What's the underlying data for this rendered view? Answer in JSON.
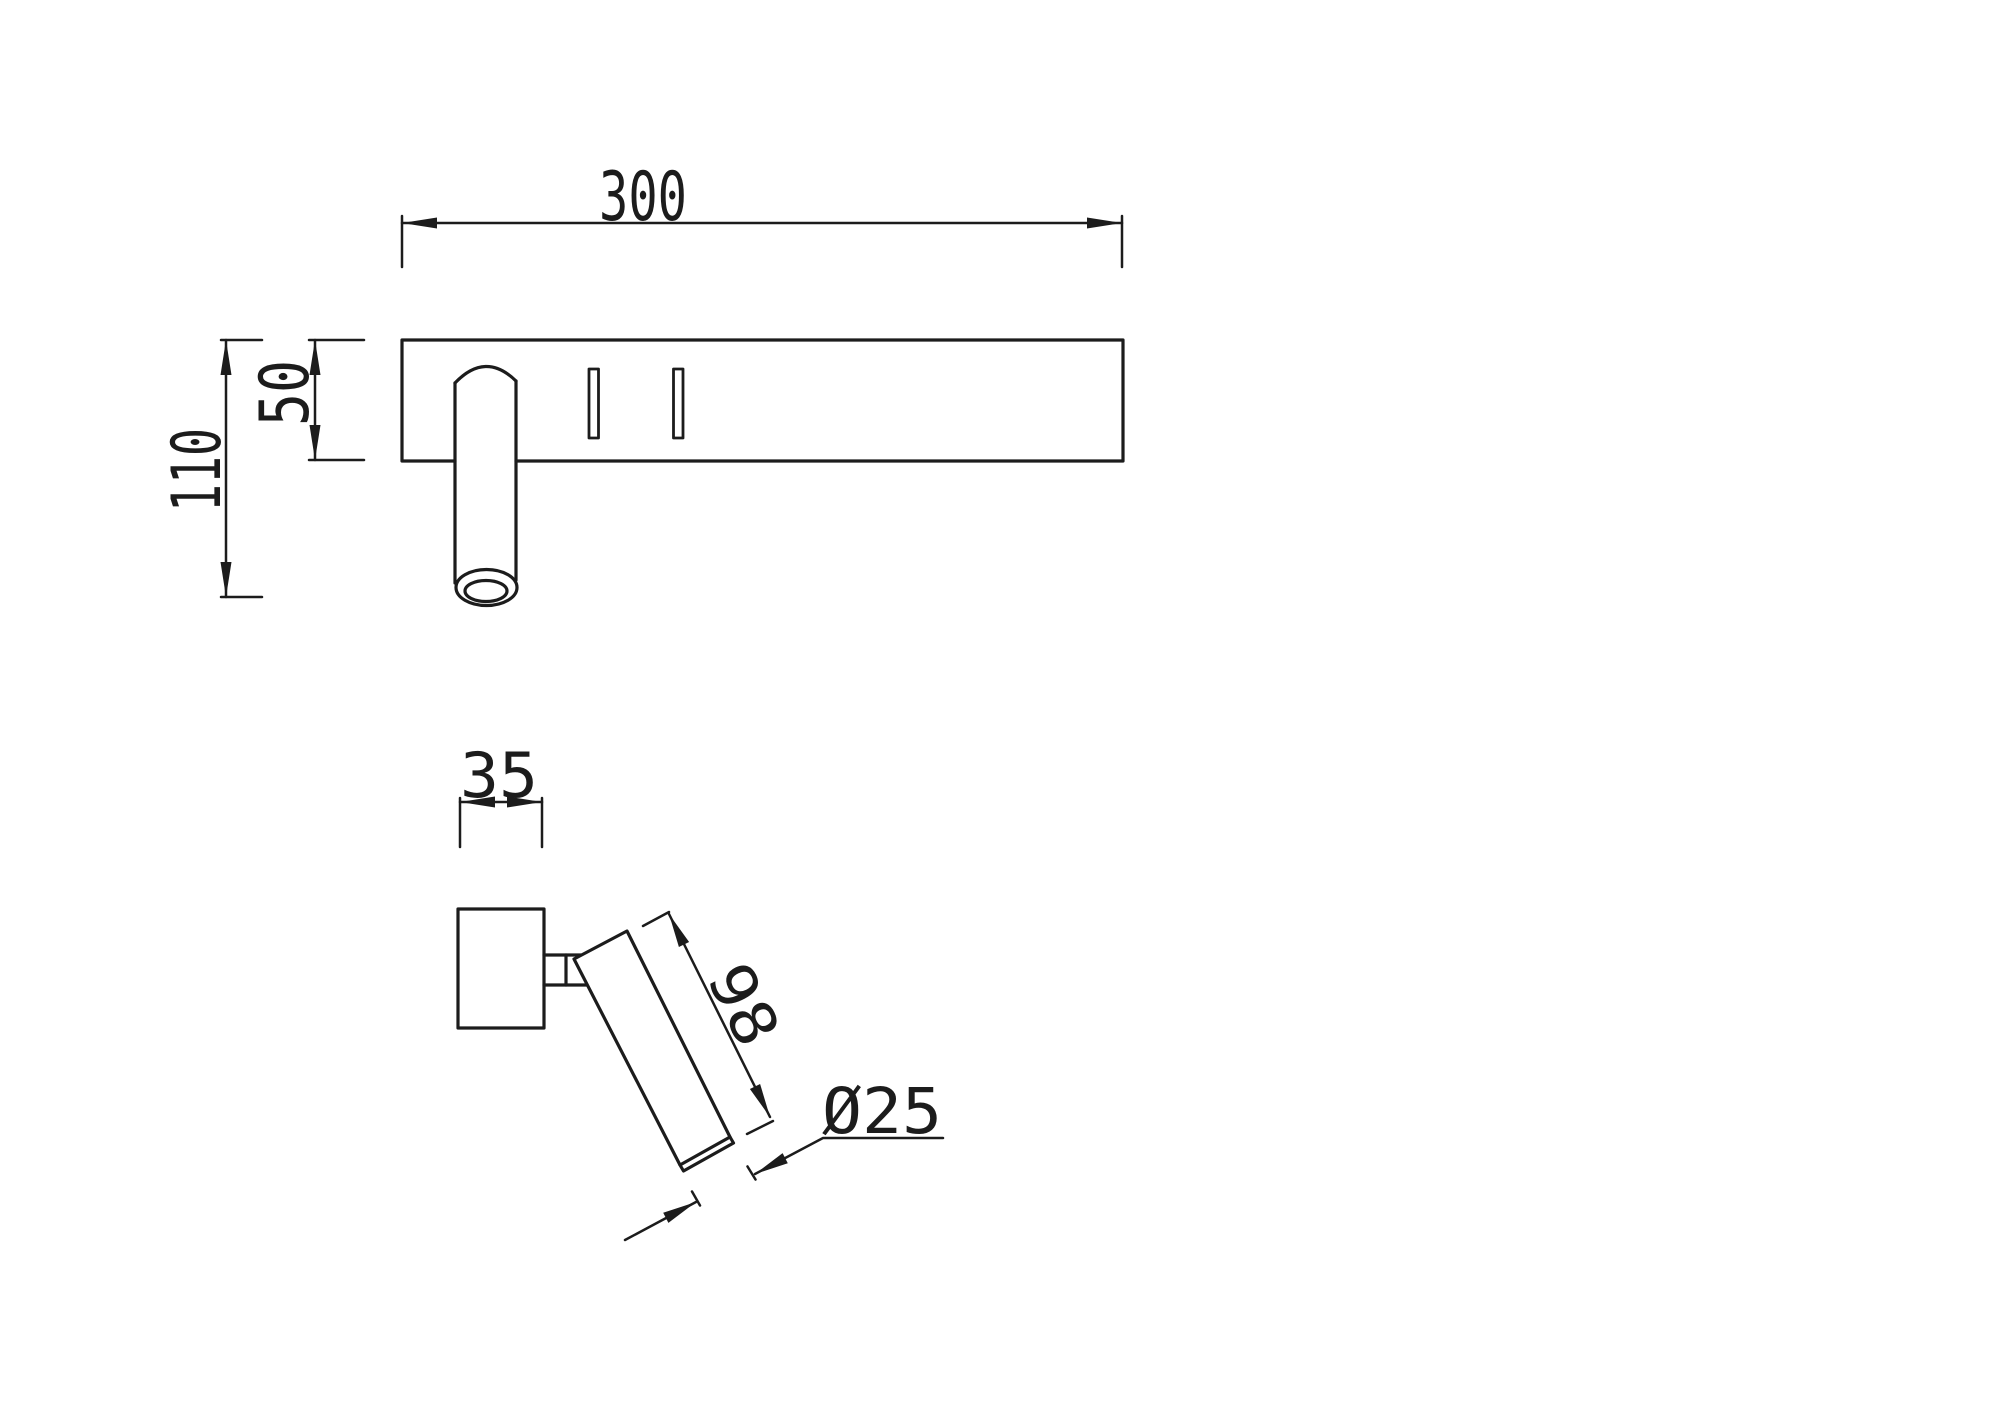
{
  "drawing": {
    "background_color": "#ffffff",
    "line_color": "#1c1c1c",
    "front_view": {
      "width_label": "300",
      "plate_height_label": "50",
      "total_depth_label": "110"
    },
    "side_view": {
      "plate_depth_label": "35",
      "spot_length_label": "98",
      "spot_diameter_label": "Ø25"
    }
  }
}
